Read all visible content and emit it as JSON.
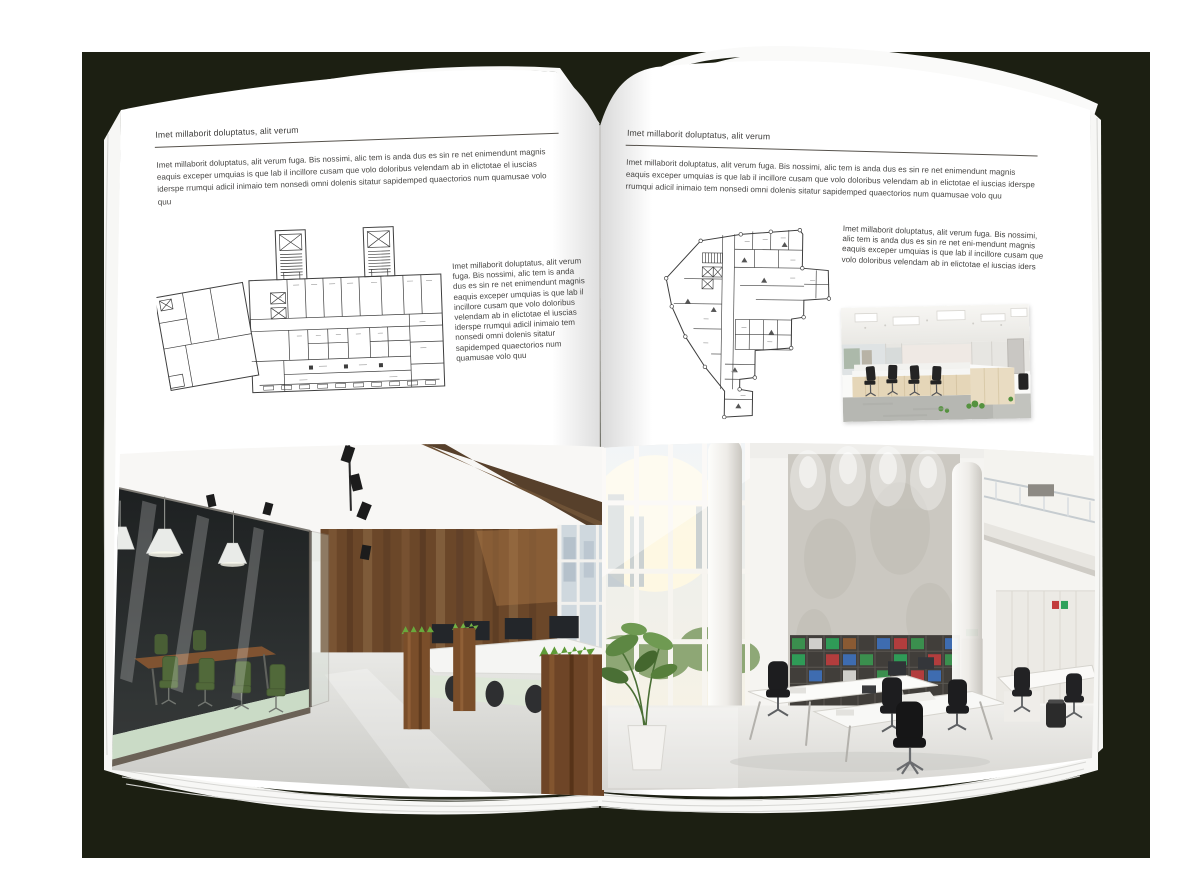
{
  "colors": {
    "backdrop": "#1c1f12",
    "page": "#ffffff",
    "text": "#454442",
    "rule": "#56524c"
  },
  "left_page": {
    "header": "Imet millaborit doluptatus, alit verum",
    "intro": "Imet millaborit doluptatus, alit verum fuga. Bis nossimi, alic tem is anda dus es sin re net enimendunt magnis eaquis exceper umquias is que lab il incillore cusam que volo doloribus velendam ab in elictotae el iuscias iderspe rrumqui adicil inimaio tem nonsedi omni dolenis sitatur sapidemped quaectorios num quamusae volo quu",
    "side_text": "Imet millaborit doluptatus, alit verum fuga. Bis nossimi, alic tem is anda dus es sin re net enimendunt magnis eaquis exceper umquias is que lab il incillore cusam que volo doloribus velendam ab in elictotae el iuscias iderspe rrumqui adicil inimaio tem nonsedi omni dolenis sitatur sapidemped quaectorios num quamusae volo quu",
    "floorplan_name": "office-floor-plan-left",
    "photo_name": "office-interior-glass-meeting-room-wood-wall"
  },
  "right_page": {
    "header": "Imet millaborit doluptatus, alit verum",
    "intro": "Imet millaborit doluptatus, alit verum fuga. Bis nossimi, alic tem is anda dus es sin re net enimendunt magnis eaquis exceper umquias is que lab il incillore cusam que volo doloribus velendam ab in elictotae el iuscias iderspe rrumqui adicil inimaio tem nonsedi omni dolenis sitatur sapidemped quaectorios num quamusae volo quu",
    "side_text": "Imet millaborit doluptatus, alit verum fuga. Bis nossimi, alic tem is anda dus es sin re net eni-mendunt magnis eaquis exceper umquias is que lab il incillore cusam que volo doloribus velendam ab in elictotae el iuscias iders",
    "floorplan_name": "office-floor-plan-right",
    "photo_small_name": "open-plan-office-desks-photo",
    "photo_large_name": "bright-atrium-office-photo"
  }
}
